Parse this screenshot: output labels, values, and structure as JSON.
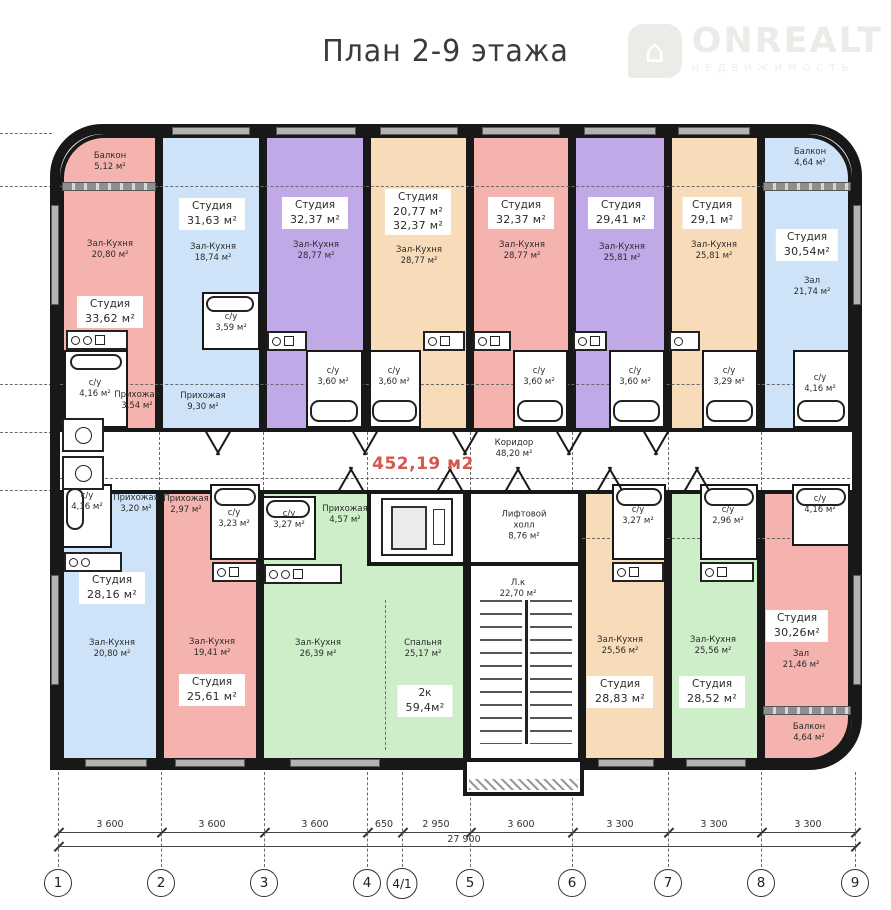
{
  "page": {
    "title": "План 2-9 этажа"
  },
  "logo": {
    "brand": "ONREALT",
    "tagline": "НЕДВИЖИМОСТЬ"
  },
  "palette": {
    "wall": "#181818",
    "accent_red": "#d6584c",
    "pink": "#f4b3ae",
    "blue": "#cfe3f8",
    "purple": "#c1a9e7",
    "peach": "#f8dcba",
    "green": "#cdeec9"
  },
  "plan": {
    "total_area": "452,19 м2",
    "corridor": {
      "name": "Коридор",
      "area": "48,20 м²"
    },
    "lift_hall": {
      "name": "Лифтовой холл",
      "area": "8,76 м²"
    },
    "stairwell": {
      "name": "Л.к",
      "area": "22,70 м²"
    },
    "apartments": {
      "t1": {
        "color": "#f4b3ae",
        "unit": {
          "name": "Студия",
          "area": "33,62 м²"
        },
        "balcony": {
          "name": "Балкон",
          "area": "5,12 м²"
        },
        "hall": {
          "name": "Зал-Кухня",
          "area": "20,80 м²"
        },
        "wc": {
          "name": "с/у",
          "area": "4,16 м²"
        },
        "entry": {
          "name": "Прихожая",
          "area": "3,54 м²"
        }
      },
      "t2": {
        "color": "#cfe3f8",
        "unit": {
          "name": "Студия",
          "area": "31,63 м²"
        },
        "hall": {
          "name": "Зал-Кухня",
          "area": "18,74 м²"
        },
        "wc": {
          "name": "с/у",
          "area": "3,59 м²"
        },
        "entry": {
          "name": "Прихожая",
          "area": "9,30 м²"
        }
      },
      "t3": {
        "color": "#c1a9e7",
        "unit": {
          "name": "Студия",
          "area": "32,37 м²"
        },
        "hall": {
          "name": "Зал-Кухня",
          "area": "28,77 м²"
        },
        "wc": {
          "name": "с/у",
          "area": "3,60 м²"
        }
      },
      "t4": {
        "color": "#f8dcba",
        "unit": {
          "name": "Студия",
          "area": "20,77 м²",
          "area2": "32,37 м²"
        },
        "hall": {
          "name": "Зал-Кухня",
          "area": "28,77 м²"
        },
        "wc": {
          "name": "с/у",
          "area": "3,60 м²"
        }
      },
      "t5": {
        "color": "#f4b3ae",
        "unit": {
          "name": "Студия",
          "area": "32,37 м²"
        },
        "hall": {
          "name": "Зал-Кухня",
          "area": "28,77 м²"
        },
        "wc": {
          "name": "с/у",
          "area": "3,60 м²"
        }
      },
      "t6": {
        "color": "#c1a9e7",
        "unit": {
          "name": "Студия",
          "area": "29,41 м²"
        },
        "hall": {
          "name": "Зал-Кухня",
          "area": "25,81 м²"
        },
        "wc": {
          "name": "с/у",
          "area": "3,60 м²"
        }
      },
      "t7": {
        "color": "#f8dcba",
        "unit": {
          "name": "Студия",
          "area": "29,1 м²"
        },
        "hall": {
          "name": "Зал-Кухня",
          "area": "25,81 м²"
        },
        "wc": {
          "name": "с/у",
          "area": "3,29 м²"
        }
      },
      "t8": {
        "color": "#cfe3f8",
        "unit": {
          "name": "Студия",
          "area": "30,54м²"
        },
        "balcony": {
          "name": "Балкон",
          "area": "4,64 м²"
        },
        "hall": {
          "name": "Зал",
          "area": "21,74 м²"
        },
        "wc": {
          "name": "с/у",
          "area": "4,16 м²"
        }
      },
      "b1": {
        "color": "#cfe3f8",
        "unit": {
          "name": "Студия",
          "area": "28,16 м²"
        },
        "hall": {
          "name": "Зал-Кухня",
          "area": "20,80 м²"
        },
        "wc": {
          "name": "с/у",
          "area": "4,16 м²"
        },
        "entry": {
          "name": "Прихожая",
          "area": "3,20 м²"
        }
      },
      "b2": {
        "color": "#f4b3ae",
        "unit": {
          "name": "Студия",
          "area": "25,61 м²"
        },
        "hall": {
          "name": "Зал-Кухня",
          "area": "19,41 м²"
        },
        "wc": {
          "name": "с/у",
          "area": "3,23 м²"
        },
        "entry": {
          "name": "Прихожая",
          "area": "2,97 м²"
        }
      },
      "b3": {
        "color": "#cdeec9",
        "unit": {
          "name": "2к",
          "area": "59,4м²"
        },
        "hall": {
          "name": "Зал-Кухня",
          "area": "26,39 м²"
        },
        "bedroom": {
          "name": "Спальня",
          "area": "25,17 м²"
        },
        "wc": {
          "name": "с/у",
          "area": "3,27 м²"
        },
        "entry": {
          "name": "Прихожая",
          "area": "4,57 м²"
        }
      },
      "b4": {
        "color": "#f8dcba",
        "unit": {
          "name": "Студия",
          "area": "28,83 м²"
        },
        "hall": {
          "name": "Зал-Кухня",
          "area": "25,56 м²"
        },
        "wc": {
          "name": "с/у",
          "area": "3,27 м²"
        }
      },
      "b5": {
        "color": "#cdeec9",
        "unit": {
          "name": "Студия",
          "area": "28,52 м²"
        },
        "hall": {
          "name": "Зал-Кухня",
          "area": "25,56 м²"
        },
        "wc": {
          "name": "с/у",
          "area": "2,96 м²"
        }
      },
      "b6": {
        "color": "#f4b3ae",
        "unit": {
          "name": "Студия",
          "area": "30,26м²"
        },
        "balcony": {
          "name": "Балкон",
          "area": "4,64 м²"
        },
        "hall": {
          "name": "Зал",
          "area": "21,46 м²"
        },
        "wc": {
          "name": "с/у",
          "area": "4,16 м²"
        }
      }
    }
  },
  "dimensions": {
    "segments": [
      "3 600",
      "3 600",
      "3 600",
      "650",
      "2 950",
      "3 600",
      "3 300",
      "3 300",
      "3 300"
    ],
    "total": "27 900",
    "axes": [
      "1",
      "2",
      "3",
      "4",
      "4/1",
      "5",
      "6",
      "7",
      "8",
      "9"
    ]
  }
}
